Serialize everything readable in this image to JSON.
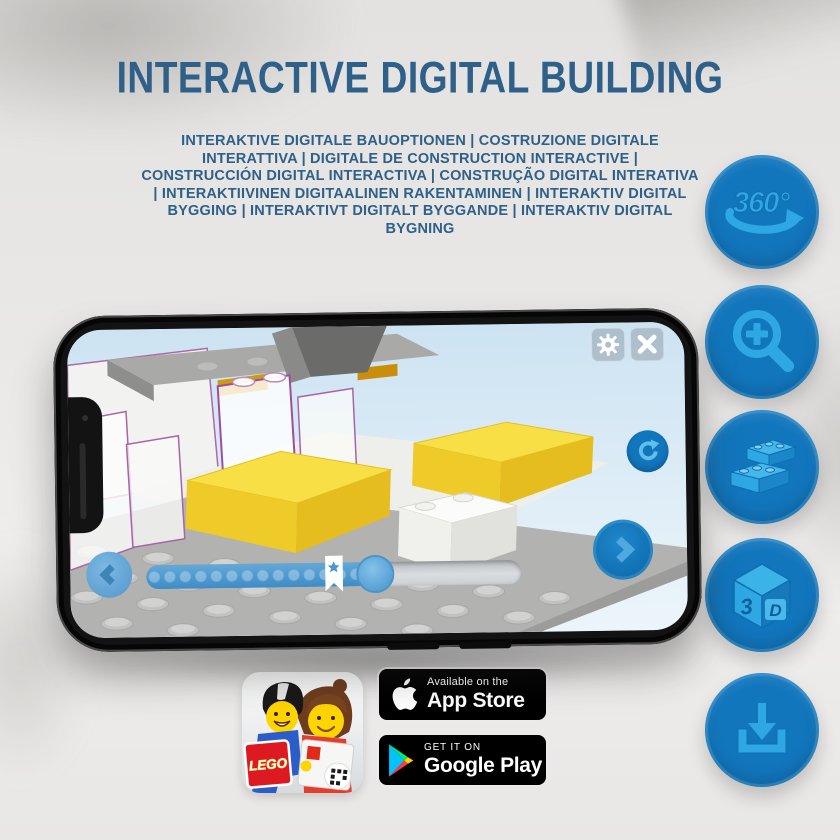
{
  "header": {
    "title": "INTERACTIVE DIGITAL BUILDING",
    "subtitle": "INTERAKTIVE DIGITALE BAUOPTIONEN | COSTRUZIONE DIGITALE INTERATTIVA | DIGITALE DE CONSTRUCTION INTERACTIVE | CONSTRUCCIÓN DIGITAL INTERACTIVA | CONSTRUÇÃO DIGITAL INTERATIVA | INTERAKTIIVINEN DIGITAALINEN RAKENTAMINEN | INTERAKTIV DIGITAL BYGGING | INTERAKTIVT DIGITALT BYGGANDE | INTERAKTIV DIGITAL BYGNING"
  },
  "feature_icons": {
    "rotation_label": "360°",
    "cube_label_3": "3",
    "cube_label_d": "D"
  },
  "app": {
    "slider": {
      "progress_percent": 61,
      "star_percent": 50
    }
  },
  "app_icon": {
    "lego_logo": "LEGO"
  },
  "badges": {
    "app_store_line1": "Available on the",
    "app_store_line2": "App Store",
    "google_play_line1": "GET IT ON",
    "google_play_line2": "Google Play"
  },
  "colors": {
    "headline_blue": "#2e608a",
    "accent_blue": "#1276bd",
    "icon_light_blue": "#2ea8e4",
    "lego_yellow": "#f7df45",
    "lego_red": "#dd1a21"
  }
}
